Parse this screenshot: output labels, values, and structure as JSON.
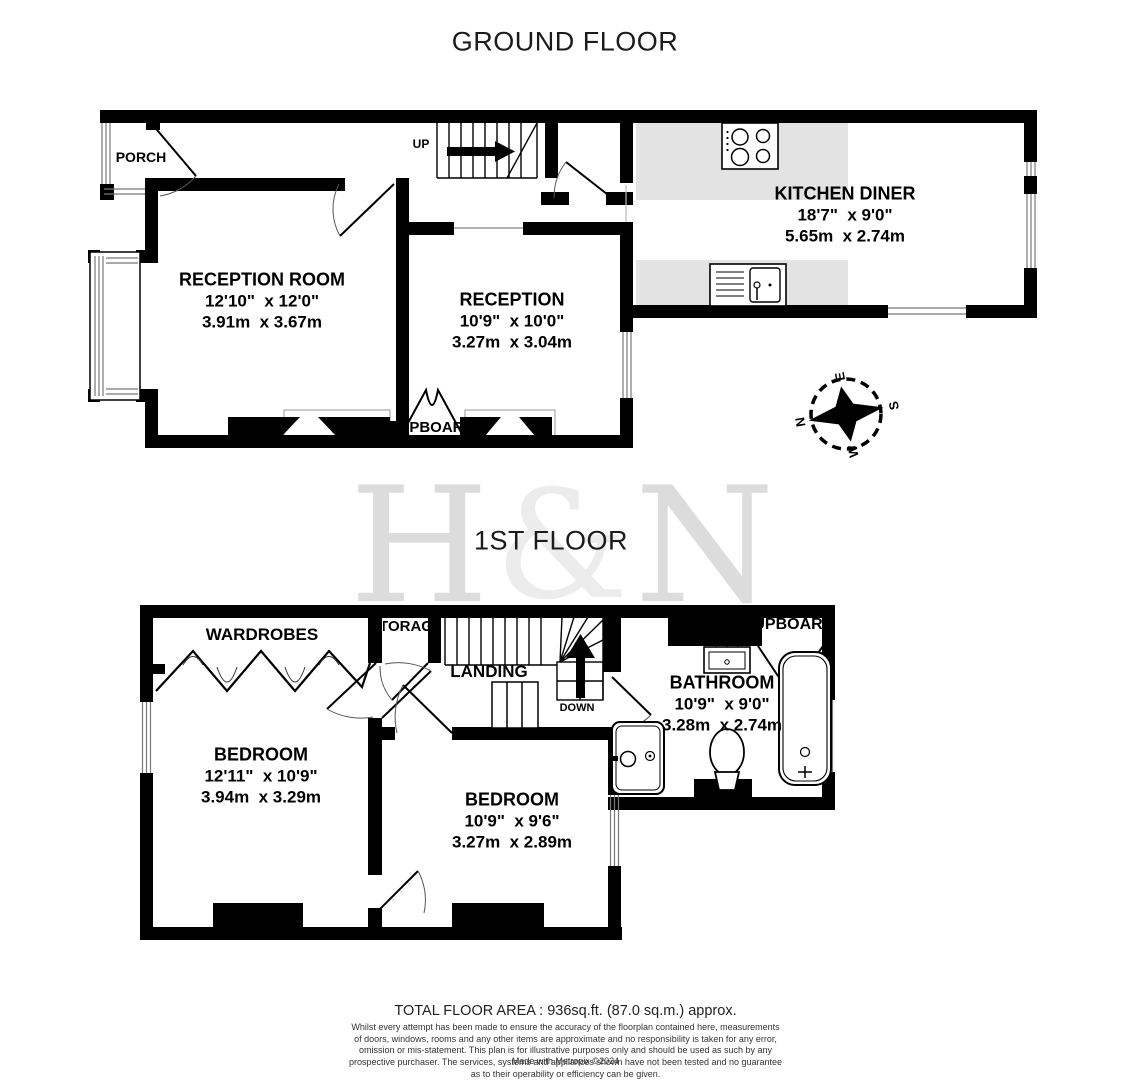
{
  "titles": {
    "ground": "GROUND FLOOR",
    "first": "1ST FLOOR"
  },
  "watermark": {
    "left": "H",
    "amp": "&",
    "right": "N"
  },
  "ground_floor": {
    "porch": "PORCH",
    "stairs_up": "UP",
    "cupboard": "CUPBOARD",
    "reception_room": {
      "name": "RECEPTION ROOM",
      "imperial": "12'10\"  x 12'0\"",
      "metric": "3.91m  x 3.67m"
    },
    "reception": {
      "name": "RECEPTION",
      "imperial": "10'9\"  x 10'0\"",
      "metric": "3.27m  x 3.04m"
    },
    "kitchen_diner": {
      "name": "KITCHEN DINER",
      "imperial": "18'7\"  x 9'0\"",
      "metric": "5.65m  x 2.74m"
    }
  },
  "first_floor": {
    "wardrobes": "WARDROBES",
    "storage": "STORAGE",
    "landing": "LANDING",
    "stairs_down": "DOWN",
    "cupboard": "CUPBOARD",
    "bedroom_1": {
      "name": "BEDROOM",
      "imperial": "12'11\"  x 10'9\"",
      "metric": "3.94m  x 3.29m"
    },
    "bedroom_2": {
      "name": "BEDROOM",
      "imperial": "10'9\"  x 9'6\"",
      "metric": "3.27m  x 2.89m"
    },
    "bathroom": {
      "name": "BATHROOM",
      "imperial": "10'9\"  x 9'0\"",
      "metric": "3.28m  x 2.74m"
    }
  },
  "compass": {
    "north": "N",
    "east": "E",
    "south": "S",
    "west": "W"
  },
  "footer": {
    "total_area": "TOTAL FLOOR AREA : 936sq.ft. (87.0 sq.m.) approx.",
    "disclaimer": "Whilst every attempt has been made to ensure the accuracy of the floorplan contained here, measurements\nof doors, windows, rooms and any other items are approximate and no responsibility is taken for any error,\nomission or mis-statement. This plan is for illustrative purposes only and should be used as such by any\nprospective purchaser. The services, systems and appliances shown have not been tested and no guarantee\nas to their operability or efficiency can be given.",
    "credit": "Made with Metropix ©2024"
  },
  "colors": {
    "wall": "#000000",
    "counter": "#e3e3e3",
    "watermark": "#dcdcdc"
  }
}
